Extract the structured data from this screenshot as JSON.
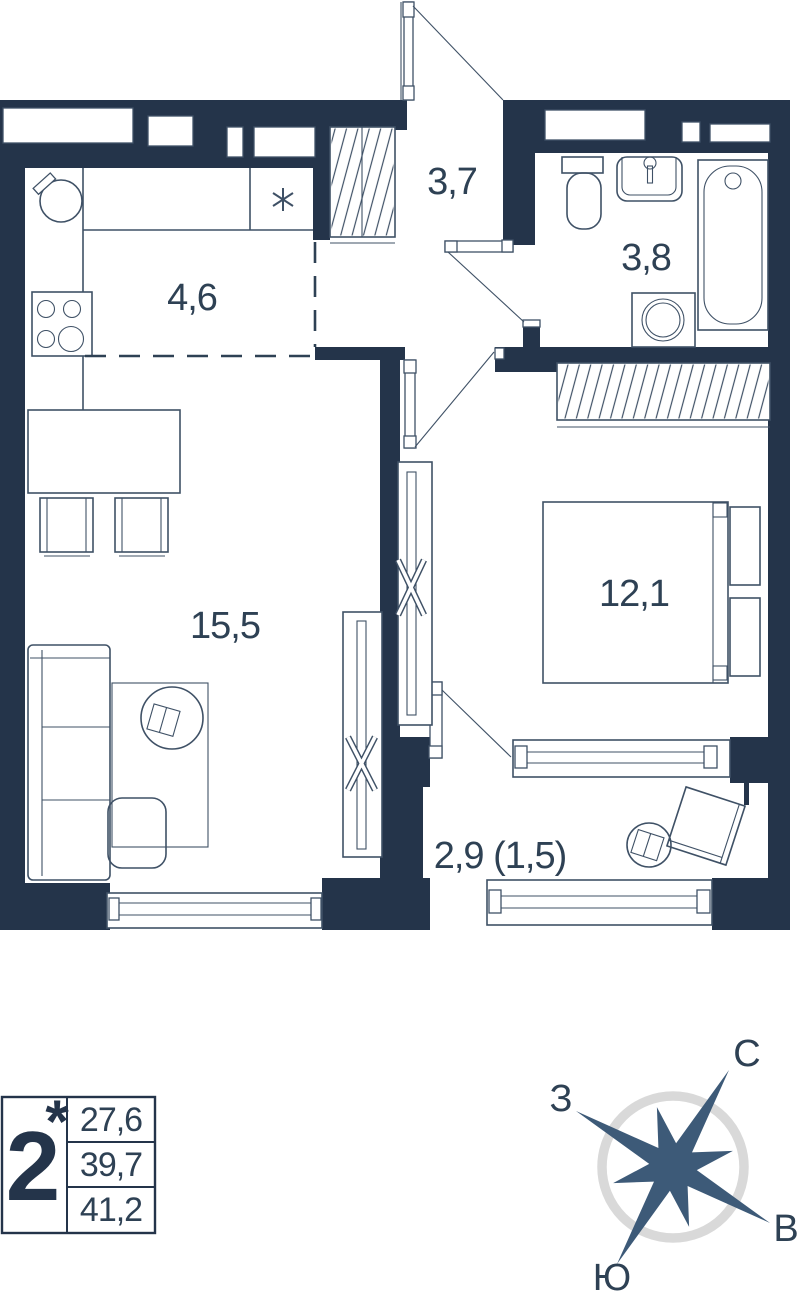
{
  "plan": {
    "labels": {
      "kitchen": "4,6",
      "hallway": "3,7",
      "bathroom": "3,8",
      "living": "15,5",
      "bedroom": "12,1",
      "balcony": "2,9 (1,5)"
    },
    "kitchen_counter_mark": "*"
  },
  "info_card": {
    "rooms_count": "2",
    "rooms_star": "*",
    "living_area": "27,6",
    "area_without_balcony": "39,7",
    "total_area": "41,2"
  },
  "compass": {
    "north": "С",
    "south": "Ю",
    "west": "З",
    "east": "В",
    "rotation_deg": 30
  },
  "colors": {
    "wall": "#24344a",
    "line": "#3f5166",
    "text": "#2e4154",
    "compass_star": "#3d5a78",
    "compass_ring": "#d9d9d9"
  }
}
